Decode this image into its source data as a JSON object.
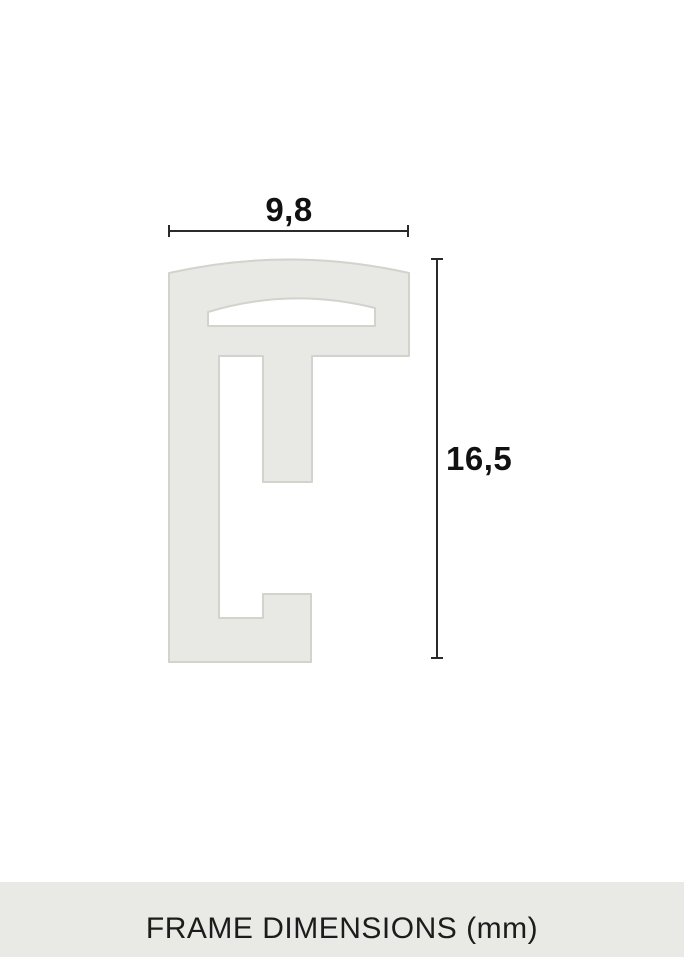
{
  "diagram": {
    "type": "frame-profile-cross-section",
    "width_label": "9,8",
    "height_label": "16,5",
    "width_mm": 9.8,
    "height_mm": 16.5,
    "unit": "mm",
    "caption": "FRAME DIMENSIONS (mm)"
  },
  "colors": {
    "background": "#ffffff",
    "profile_fill": "#e8e8e4",
    "profile_stroke": "#d2d3cd",
    "dimension_line": "#2a2a2a",
    "label_text": "#111111",
    "caption_band": "#e9e9e5",
    "caption_text": "#1c1c1c"
  }
}
